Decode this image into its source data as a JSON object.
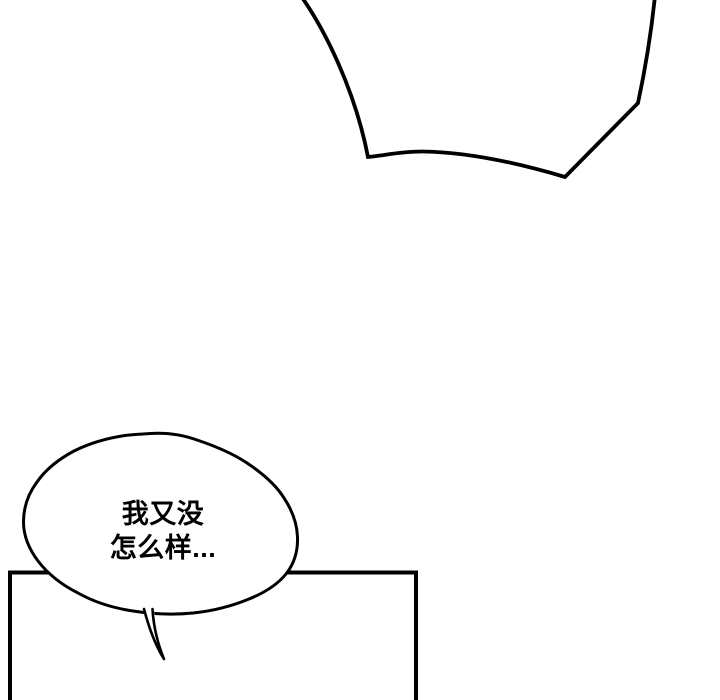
{
  "page": {
    "background_color": "#ffffff",
    "ink_color": "#000000"
  },
  "comic": {
    "speech_bubble": {
      "line1": "我又没",
      "line2": "怎么样..."
    }
  }
}
